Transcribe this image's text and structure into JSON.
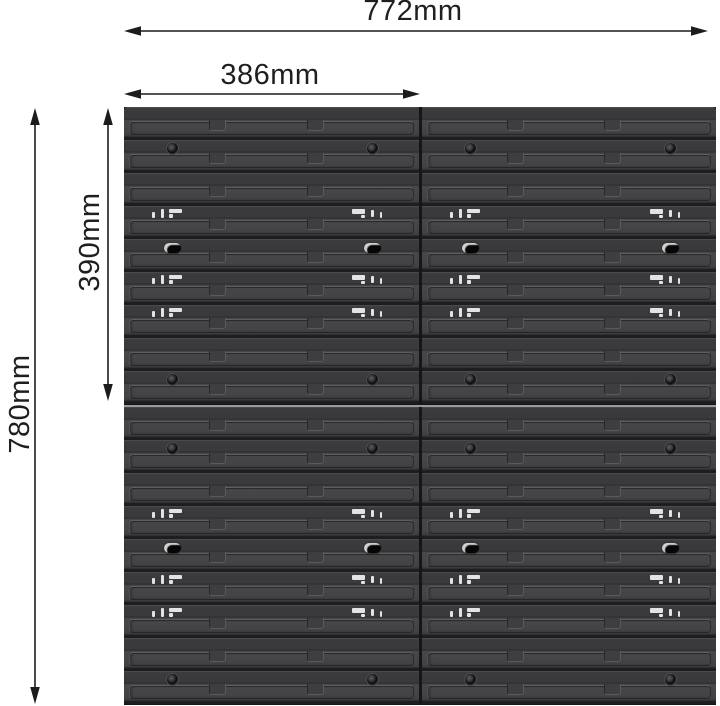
{
  "diagram": {
    "description": "wall-mounted slatted storage panel with dimension arrows",
    "background": "#ffffff"
  },
  "dimensions": {
    "total_width": "772mm",
    "panel_width": "386mm",
    "total_height": "780mm",
    "panel_height": "390mm"
  },
  "panel": {
    "grid": {
      "columns": 2,
      "rows": 2
    },
    "slats_per_plate": 9,
    "slat_pattern": [
      "plain",
      "screws",
      "plain",
      "clips",
      "slots",
      "clips",
      "clips",
      "plain",
      "screws"
    ],
    "hole_center_offsets_px": [
      48,
      248
    ],
    "clip_group_offsets_px": [
      28,
      228
    ],
    "colors": {
      "slat_face": "#424244",
      "slat_gap": "#1d1d1f",
      "groove_highlight": "#5e5e60",
      "vertical_seam": "#161618",
      "horizontal_seam": "#9a9a9a",
      "clip_highlight": "#e3e3e3",
      "dimension_line": "#1c1c1c"
    }
  }
}
